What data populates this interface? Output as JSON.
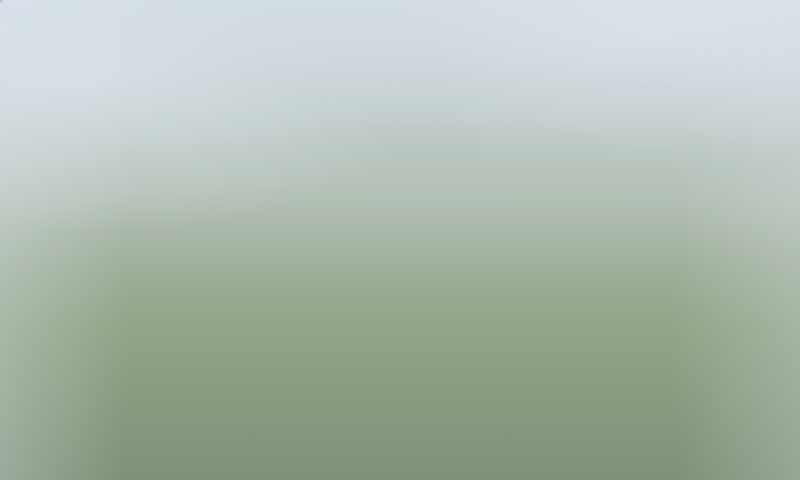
{
  "annotations": {
    "box_color": "#fdf500",
    "text_color": "#c3281b",
    "line_color": "#f8f400",
    "labels": [
      {
        "text": "V2",
        "x": 412,
        "y": 238,
        "w": 45,
        "h": 27,
        "leader": [
          413,
          264,
          388,
          278
        ]
      },
      {
        "text": "V1",
        "x": 493,
        "y": 282,
        "w": 45,
        "h": 28,
        "leader": [
          495,
          309,
          467,
          322
        ]
      },
      {
        "text": "QL 18",
        "x": 218,
        "y": 376,
        "w": 126,
        "h": 30,
        "leader": null
      }
    ]
  },
  "scene": {
    "palette": {
      "haze_fill": "#b6c1ca",
      "haze_edge": "#9aa7b2",
      "tree_sets": [
        [
          "#768874",
          "#86987f",
          "#69795f"
        ],
        [
          "#4e663d",
          "#5f7a48",
          "#41573a"
        ],
        [
          "#4b6836",
          "#5d7f43",
          "#3d5630"
        ],
        [
          "#35462c",
          "#415637",
          "#2b3a26"
        ]
      ]
    },
    "haze_slabs": [
      [
        10,
        140,
        60,
        95,
        -18,
        0.8
      ],
      [
        65,
        100,
        55,
        90,
        -18,
        0.75
      ],
      [
        115,
        55,
        50,
        85,
        -18,
        0.7
      ],
      [
        25,
        15,
        50,
        75,
        -18,
        0.65
      ],
      [
        95,
        0,
        45,
        60,
        -15,
        0.6
      ],
      [
        165,
        0,
        60,
        45,
        -20,
        0.65
      ],
      [
        230,
        0,
        55,
        40,
        -20,
        0.6
      ],
      [
        300,
        0,
        60,
        40,
        -20,
        0.55
      ],
      [
        370,
        0,
        70,
        45,
        -20,
        0.6
      ],
      [
        450,
        12,
        80,
        50,
        -20,
        0.6
      ],
      [
        545,
        0,
        75,
        55,
        -20,
        0.65
      ],
      [
        432,
        58,
        88,
        48,
        -20,
        0.55
      ],
      [
        520,
        62,
        100,
        55,
        -20,
        0.6
      ],
      [
        630,
        0,
        60,
        90,
        -18,
        0.7
      ],
      [
        700,
        12,
        55,
        85,
        -18,
        0.7
      ],
      [
        748,
        62,
        52,
        80,
        -18,
        0.65
      ],
      [
        622,
        100,
        80,
        55,
        -20,
        0.6
      ],
      [
        700,
        122,
        75,
        50,
        -20,
        0.6
      ],
      [
        738,
        182,
        62,
        45,
        -20,
        0.6
      ],
      [
        600,
        170,
        70,
        45,
        -20,
        0.5
      ],
      [
        0,
        215,
        42,
        62,
        -15,
        0.55
      ]
    ],
    "grounds": [
      {
        "pts": "152,218 238,96 322,44 400,60 470,95 600,170 645,215 645,268 560,315 470,300 380,295 300,290 210,292",
        "f": "#8ca179",
        "o": 0.9
      },
      {
        "pts": "205,312 258,295 332,330 272,352",
        "f": "#b8b2a2",
        "o": 0.85
      },
      {
        "pts": "0,322 150,352 310,408 480,480 0,480",
        "f": "#4a5440",
        "o": 0.92
      },
      {
        "pts": "0,360 120,390 260,445 330,480 0,480",
        "f": "#3d4734",
        "o": 0.85
      }
    ],
    "slabs": [
      [
        648,
        252,
        62,
        26,
        -22,
        "#8c968b",
        0.9
      ],
      [
        700,
        298,
        66,
        28,
        -22,
        "#88938a",
        0.9
      ],
      [
        745,
        345,
        62,
        26,
        -22,
        "#84908a",
        0.9
      ],
      [
        672,
        352,
        60,
        26,
        -22,
        "#7f8b85",
        0.9
      ],
      [
        700,
        390,
        112,
        38,
        -24,
        "#75817c",
        0.92
      ],
      [
        652,
        450,
        112,
        36,
        -24,
        "#6d7973",
        0.92
      ],
      [
        758,
        248,
        52,
        24,
        -22,
        "#8c968b",
        0.85
      ],
      [
        762,
        440,
        56,
        26,
        -24,
        "#707c76",
        0.9
      ],
      [
        698,
        200,
        56,
        22,
        -22,
        "#909a8f",
        0.8
      ],
      [
        28,
        372,
        92,
        34,
        -16,
        "#39432f",
        0.95
      ],
      [
        140,
        420,
        100,
        34,
        -16,
        "#333d2b",
        0.95
      ],
      [
        6,
        432,
        72,
        30,
        -16,
        "#2f3928",
        0.95
      ],
      [
        240,
        455,
        96,
        30,
        -16,
        "#333d2c",
        0.95
      ],
      [
        90,
        330,
        70,
        26,
        -16,
        "#404a35",
        0.9
      ]
    ],
    "paths": [
      {
        "d": "M 45,218 C 140,258 220,295 312,338",
        "w": 11,
        "c": "#a2a7a5",
        "o": 0.85
      },
      {
        "d": "M 150,301 C 205,268 255,252 302,250",
        "w": 3.5,
        "c": "#b3aea1",
        "o": 0.9
      },
      {
        "d": "M 158,311 C 212,278 262,262 308,260",
        "w": 3,
        "c": "#b3aea1",
        "o": 0.8
      },
      {
        "d": "M 167,321 C 221,288 270,272 313,270",
        "w": 2.5,
        "c": "#b3aea1",
        "o": 0.7
      },
      {
        "d": "M -20,297 C 140,316 300,372 545,500",
        "w": 58,
        "c": "#6d7c63",
        "o": 0.9
      },
      {
        "d": "M -20,297 C 140,316 300,372 545,500",
        "w": 46,
        "c": "#84888a",
        "o": 1
      },
      {
        "d": "M -20,297 C 140,316 300,372 545,500",
        "w": 4,
        "c": "#55684a",
        "o": 0.9
      },
      {
        "d": "M -20,288 C 140,307 300,363 545,491",
        "w": 1.6,
        "c": "#e8eae8",
        "o": 0.9,
        "dash": "9 13"
      },
      {
        "d": "M -20,306 C 140,325 300,381 545,509",
        "w": 1.6,
        "c": "#e8eae8",
        "o": 0.9,
        "dash": "9 13"
      },
      {
        "d": "M 696,78 C 660,240 628,360 610,495",
        "w": 32,
        "c": "#72816a",
        "o": 0.85
      },
      {
        "d": "M 696,78 C 660,240 628,360 610,495",
        "w": 23,
        "c": "#85898b",
        "o": 1
      },
      {
        "d": "M 696,78 C 660,240 628,360 610,495",
        "w": 1.4,
        "c": "#e5e7e6",
        "o": 0.85,
        "dash": "8 11"
      },
      {
        "d": "M 676,-10 L 815,165",
        "w": 15,
        "c": "#9aa4ab",
        "o": 0.38
      },
      {
        "d": "M 757,-15 C 748,90 738,190 730,275",
        "w": 13,
        "c": "#9aa4ab",
        "o": 0.33
      },
      {
        "d": "M 300,330 C 390,365 480,410 560,452",
        "w": 13,
        "c": "#8f9492",
        "o": 0.95
      },
      {
        "d": "M 596,238 C 590,280 584,320 578,357",
        "w": 9,
        "c": "#969b99",
        "o": 0.9
      },
      {
        "d": "M 268,150 C 340,180 420,210 520,250",
        "w": 2.5,
        "c": "#d6cfbf",
        "o": 0.45
      },
      {
        "d": "M 300,110 C 360,140 450,170 560,210",
        "w": 2.5,
        "c": "#d6cfbf",
        "o": 0.4
      },
      {
        "d": "M 230,190 C 300,225 390,255 480,285",
        "w": 2.5,
        "c": "#d6cfbf",
        "o": 0.45
      }
    ],
    "tree_clusters": [
      [
        0,
        30,
        250,
        220,
        42,
        7,
        0,
        4,
        9,
        0.85
      ],
      [
        250,
        0,
        260,
        70,
        20,
        11,
        0,
        3,
        7,
        0.7
      ],
      [
        545,
        0,
        255,
        210,
        38,
        13,
        0,
        3,
        8,
        0.7
      ],
      [
        628,
        225,
        172,
        255,
        40,
        17,
        1,
        4,
        9,
        0.95
      ],
      [
        250,
        100,
        320,
        200,
        30,
        19,
        2,
        3,
        7,
        1
      ],
      [
        0,
        252,
        360,
        58,
        34,
        23,
        2,
        4,
        8,
        1
      ],
      [
        0,
        330,
        340,
        150,
        30,
        29,
        3,
        5,
        10,
        1
      ],
      [
        330,
        398,
        300,
        82,
        24,
        31,
        3,
        4,
        8,
        1
      ],
      [
        40,
        200,
        250,
        92,
        20,
        37,
        1,
        3,
        7,
        0.95
      ],
      [
        550,
        60,
        115,
        185,
        18,
        41,
        1,
        3,
        6,
        0.9
      ],
      [
        600,
        360,
        200,
        120,
        26,
        43,
        3,
        5,
        10,
        1
      ]
    ],
    "towers": [
      [
        318,
        80,
        40,
        64
      ],
      [
        282,
        103,
        38,
        60
      ],
      [
        373,
        99,
        40,
        64
      ],
      [
        414,
        120,
        38,
        62
      ],
      [
        452,
        141,
        46,
        80
      ],
      [
        247,
        131,
        38,
        62
      ],
      [
        213,
        161,
        38,
        62
      ],
      [
        184,
        189,
        38,
        60
      ],
      [
        208,
        215,
        44,
        78
      ],
      [
        252,
        187,
        40,
        66
      ],
      [
        288,
        243,
        64,
        50
      ],
      [
        340,
        128,
        36,
        56
      ],
      [
        510,
        176,
        40,
        66
      ],
      [
        585,
        188,
        40,
        66
      ],
      [
        545,
        246,
        40,
        70
      ],
      [
        612,
        252,
        40,
        68
      ],
      [
        388,
        291,
        54,
        98
      ],
      [
        480,
        339,
        58,
        104
      ]
    ],
    "red_buildings": [
      [
        342,
        184,
        58,
        46
      ],
      [
        326,
        206,
        32,
        22
      ],
      [
        389,
        245,
        44,
        28
      ],
      [
        540,
        456,
        34,
        20
      ]
    ],
    "podium": {
      "cx": 468,
      "cy": 372,
      "w": 300,
      "h": 88,
      "rot": -19.5
    },
    "courts": [
      {
        "cx": 558,
        "cy": 321,
        "w": 84,
        "h": 44,
        "rot": -20,
        "cells": 3,
        "court": "#a0563f"
      },
      {
        "cx": 432,
        "cy": 291,
        "w": 32,
        "h": 16,
        "rot": -20,
        "cells": 2,
        "court": "#4e8d55"
      }
    ],
    "pool": {
      "cx": 463,
      "cy": 305,
      "w": 20,
      "h": 9,
      "rot": -20,
      "c": "#2e7fae"
    },
    "parking_rows": [
      [
        590,
        252
      ],
      [
        588,
        265
      ],
      [
        587,
        277
      ],
      [
        585,
        290
      ],
      [
        583,
        302
      ],
      [
        582,
        315
      ],
      [
        580,
        327
      ],
      [
        578,
        340
      ],
      [
        612,
        248
      ],
      [
        610,
        260
      ],
      [
        609,
        273
      ],
      [
        607,
        285
      ],
      [
        605,
        298
      ]
    ],
    "parking_colors": [
      "#22262a",
      "#3a3f44",
      "#2d3237",
      "#15191d",
      "#44494e"
    ],
    "cars": [
      [
        30,
        295,
        7,
        "#e9ecec"
      ],
      [
        118,
        305,
        9,
        "#2e3338"
      ],
      [
        176,
        320,
        11,
        "#98271d"
      ],
      [
        240,
        337,
        13,
        "#33383d"
      ],
      [
        388,
        412,
        22,
        "#34393e"
      ],
      [
        455,
        447,
        24,
        "#2c3136"
      ],
      [
        142,
        327,
        10,
        "#3a4045"
      ],
      [
        200,
        342,
        12,
        "#d9dcdc",
        15,
        6
      ],
      [
        300,
        381,
        17,
        "#b9974e",
        13,
        7
      ],
      [
        415,
        442,
        23,
        "#e9ebea"
      ],
      [
        678,
        152,
        -80,
        "#eaeced"
      ],
      [
        655,
        240,
        -80,
        "#2c3136"
      ],
      [
        634,
        310,
        -78,
        "#4273a8"
      ],
      [
        620,
        408,
        -76,
        "#d9dcdc"
      ],
      [
        352,
        352,
        25,
        "#2f343a",
        9,
        4
      ],
      [
        402,
        379,
        26,
        "#e9ebea",
        9,
        4
      ],
      [
        438,
        397,
        26,
        "#8e2620",
        9,
        4
      ],
      [
        470,
        413,
        26,
        "#caa04a",
        12,
        5
      ]
    ]
  }
}
